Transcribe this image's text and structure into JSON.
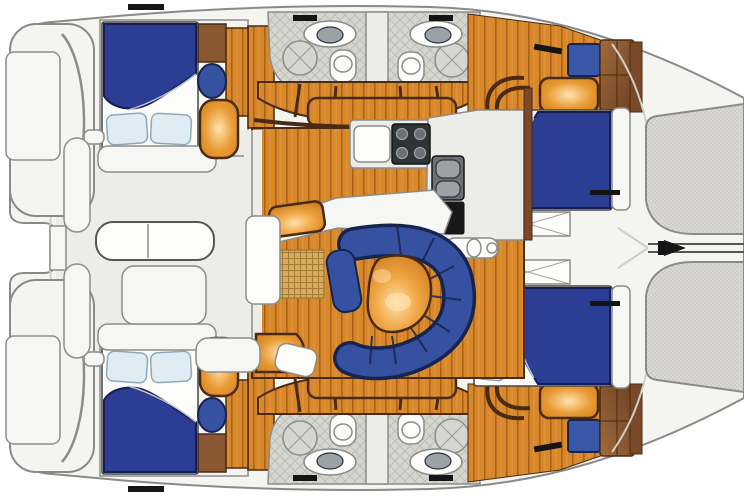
{
  "diagram": {
    "kind": "catamaran-yacht-floor-plan",
    "orientation": "bow-right-stern-left",
    "legend": {
      "boat": "Catamaran floor plan",
      "port_aft_cabin": "Aft double berth (port)",
      "stbd_aft_cabin": "Aft double berth (starboard)",
      "port_fwd_cabin": "Forward double berth (port)",
      "stbd_fwd_cabin": "Forward double berth (starboard)",
      "head": "Head / shower compartment",
      "salon": "Salon with settee and table",
      "galley": "Galley: stove, sink, refrigerator",
      "nav": "Chart table",
      "cockpit": "Aft cockpit with table and seats",
      "stern_platform": "Stern swim platform",
      "foredeck": "Foredeck lockers",
      "trampoline": "Bow trampoline",
      "steps": "Companionway steps",
      "mat": "Woven floor mat"
    },
    "icons": [
      "double-berth-icon",
      "pillow-icon",
      "toilet-icon",
      "sink-icon",
      "shower-icon",
      "stove-burner-icon",
      "fridge-icon",
      "settee-icon",
      "table-icon",
      "wardrobe-icon",
      "deck-locker-icon",
      "trampoline-mesh-icon",
      "bowsprit-icon",
      "step-icon"
    ]
  },
  "colors": {
    "deck": "#f4f4f1",
    "deck-line": "#8a8a88",
    "cockpit-floor": "#ecece9",
    "faint": "#cfcfca",
    "wall": "#8c8c88",
    "white": "#fcfcfa",
    "bench-white": "#f6f6f4",
    "wood-base": "#d8882b",
    "wood-line": "#a96417",
    "wood-hi": "#eaa04a",
    "step-stroke": "#4a2a12",
    "bed-blue": "#2b3e94",
    "bed-stroke": "#141d55",
    "pillow": "#dfecf3",
    "pillow-stroke": "#8fa9b8",
    "settee": "#35519f",
    "settee-dark": "#16244f",
    "navy-box": "#3a57a8",
    "table-hi": "#ffdfae",
    "table-mid": "#f0a844",
    "table-dark": "#c9761d",
    "glow-hi": "#ffe3b2",
    "glow-mid": "#e89a33",
    "glow-dark": "#cf7f22",
    "tile-bg": "#d6d6d1",
    "tile-line": "#bcbcb5",
    "mesh-bg": "#dad9d3",
    "mesh-dot": "#b2b1a9",
    "cabinet": "#8a5733",
    "wardrobe-hi": "#a06a3c",
    "wardrobe-dark": "#6e4222",
    "hullwall": "#7a4a28",
    "stove": "#2e3338",
    "steel": "#9aa2a8",
    "steel-dark": "#6a7076",
    "fridge": "#17181a",
    "mat-bg": "#d8ab5e",
    "mat-line": "#a37c35",
    "black": "#151515"
  }
}
